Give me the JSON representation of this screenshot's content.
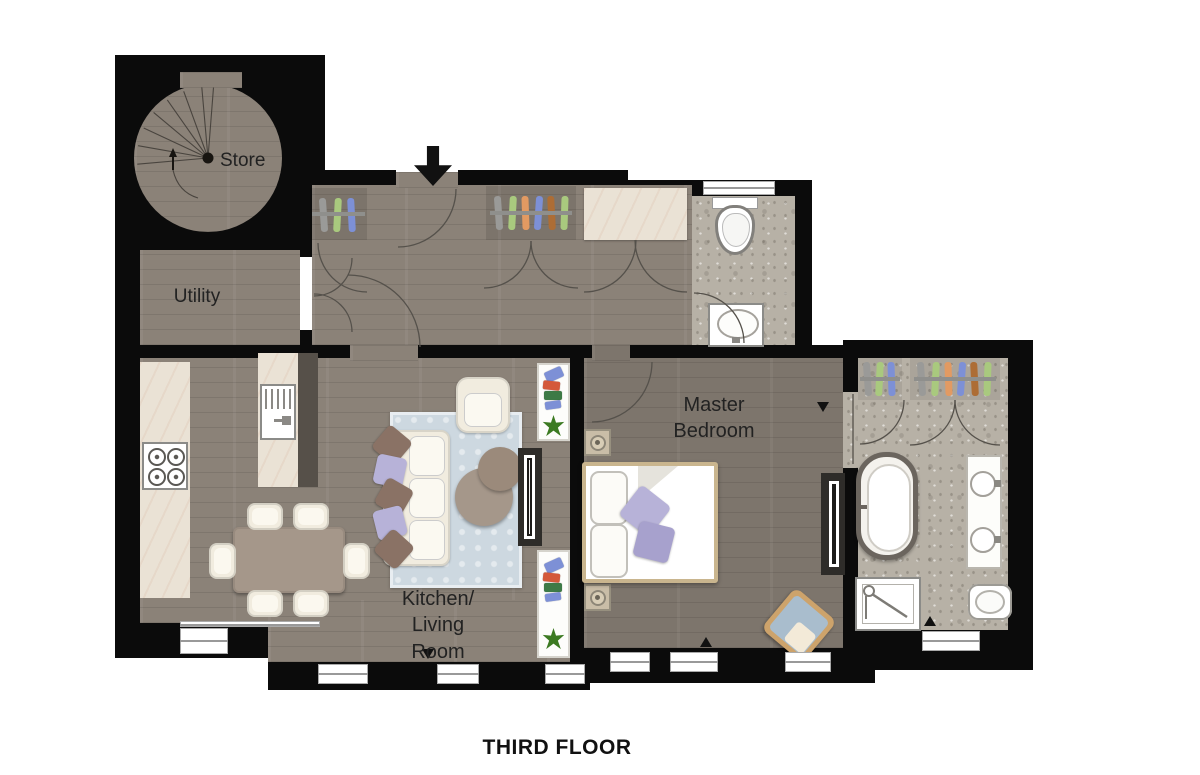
{
  "title": "THIRD FLOOR",
  "rooms": {
    "store": "Store",
    "utility": "Utility",
    "kitchen_living": "Kitchen/\nLiving\nRoom",
    "master_bedroom": "Master\nBedroom"
  },
  "colors": {
    "wall": "#0b0b0b",
    "wood": "#8b8278",
    "wood-dark": "#7d756c",
    "stone": "#b7b1a6",
    "marble": "#eae2d5",
    "cream": "#f1ecdf",
    "rug": "#cdd8e0",
    "pillow-brown": "#8a7265",
    "pillow-purple": "#b7b2d8",
    "pillow-purple-dark": "#a7a1cd",
    "table-brown": "#a5978a",
    "bed-frame": "#c9b58e",
    "dark-unit": "#2e2c29",
    "plant": "#3c7a22",
    "hanger-gray": "#9a9a98",
    "hanger-green": "#a9c97e",
    "hanger-orange": "#e29a62",
    "hanger-blue": "#7d90d6",
    "hanger-brown": "#ad6d35",
    "chair-blue": "#a9bdcd",
    "chair-tan": "#cda36b"
  },
  "furniture": [
    "spiral-staircase",
    "hall-wardrobes",
    "guest-wc-toilet",
    "guest-wc-sink",
    "kitchen-hob",
    "kitchen-island-sink",
    "dining-table-six-chairs",
    "sofa",
    "armchair",
    "coffee-tables",
    "rug",
    "bookshelves",
    "media-wall",
    "double-bed",
    "nightstand-lamps",
    "bedroom-chair",
    "bedroom-tv-unit",
    "ensuite-wardrobes",
    "freestanding-bathtub",
    "double-vanity",
    "shower",
    "ensuite-toilet"
  ]
}
